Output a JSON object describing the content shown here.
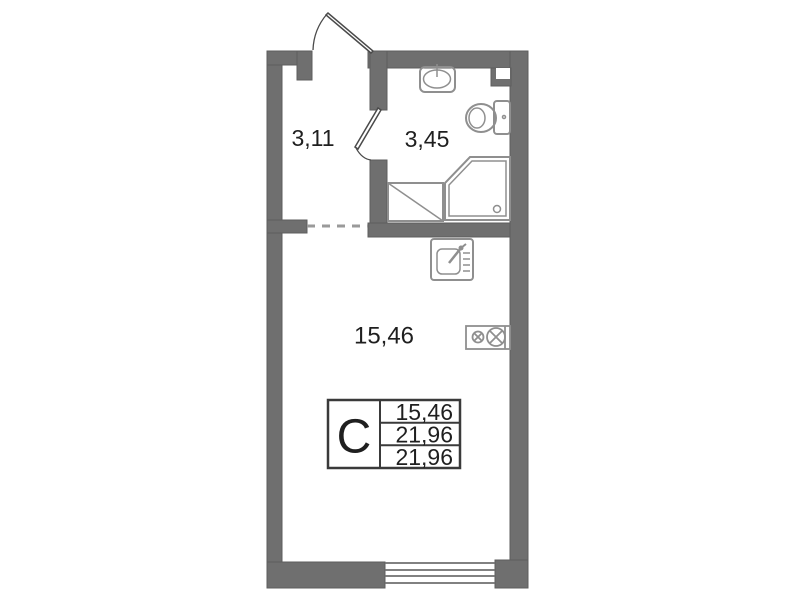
{
  "floorplan": {
    "rooms": [
      {
        "name": "hallway",
        "area_label": "3,11"
      },
      {
        "name": "bathroom",
        "area_label": "3,45"
      },
      {
        "name": "living-room",
        "area_label": "15,46"
      }
    ],
    "legend": {
      "type_letter": "С",
      "values": [
        "15,46",
        "21,96",
        "21,96"
      ]
    },
    "fixtures": [
      "entry-door-icon",
      "interior-door-icon",
      "washbasin-icon",
      "toilet-icon",
      "corner-shower-icon",
      "washer-zone-icon",
      "kitchen-sink-icon",
      "stove-icon",
      "duct-icon",
      "window-icon"
    ],
    "colors": {
      "background": "#ffffff",
      "wall": "#6f6f6f",
      "fixture_outline": "#8f8f8f",
      "door_line": "#4a4a4a",
      "text": "#1f1f1f",
      "table_border": "#3a3a3a",
      "dashed_opening": "#9a9a9a"
    }
  }
}
